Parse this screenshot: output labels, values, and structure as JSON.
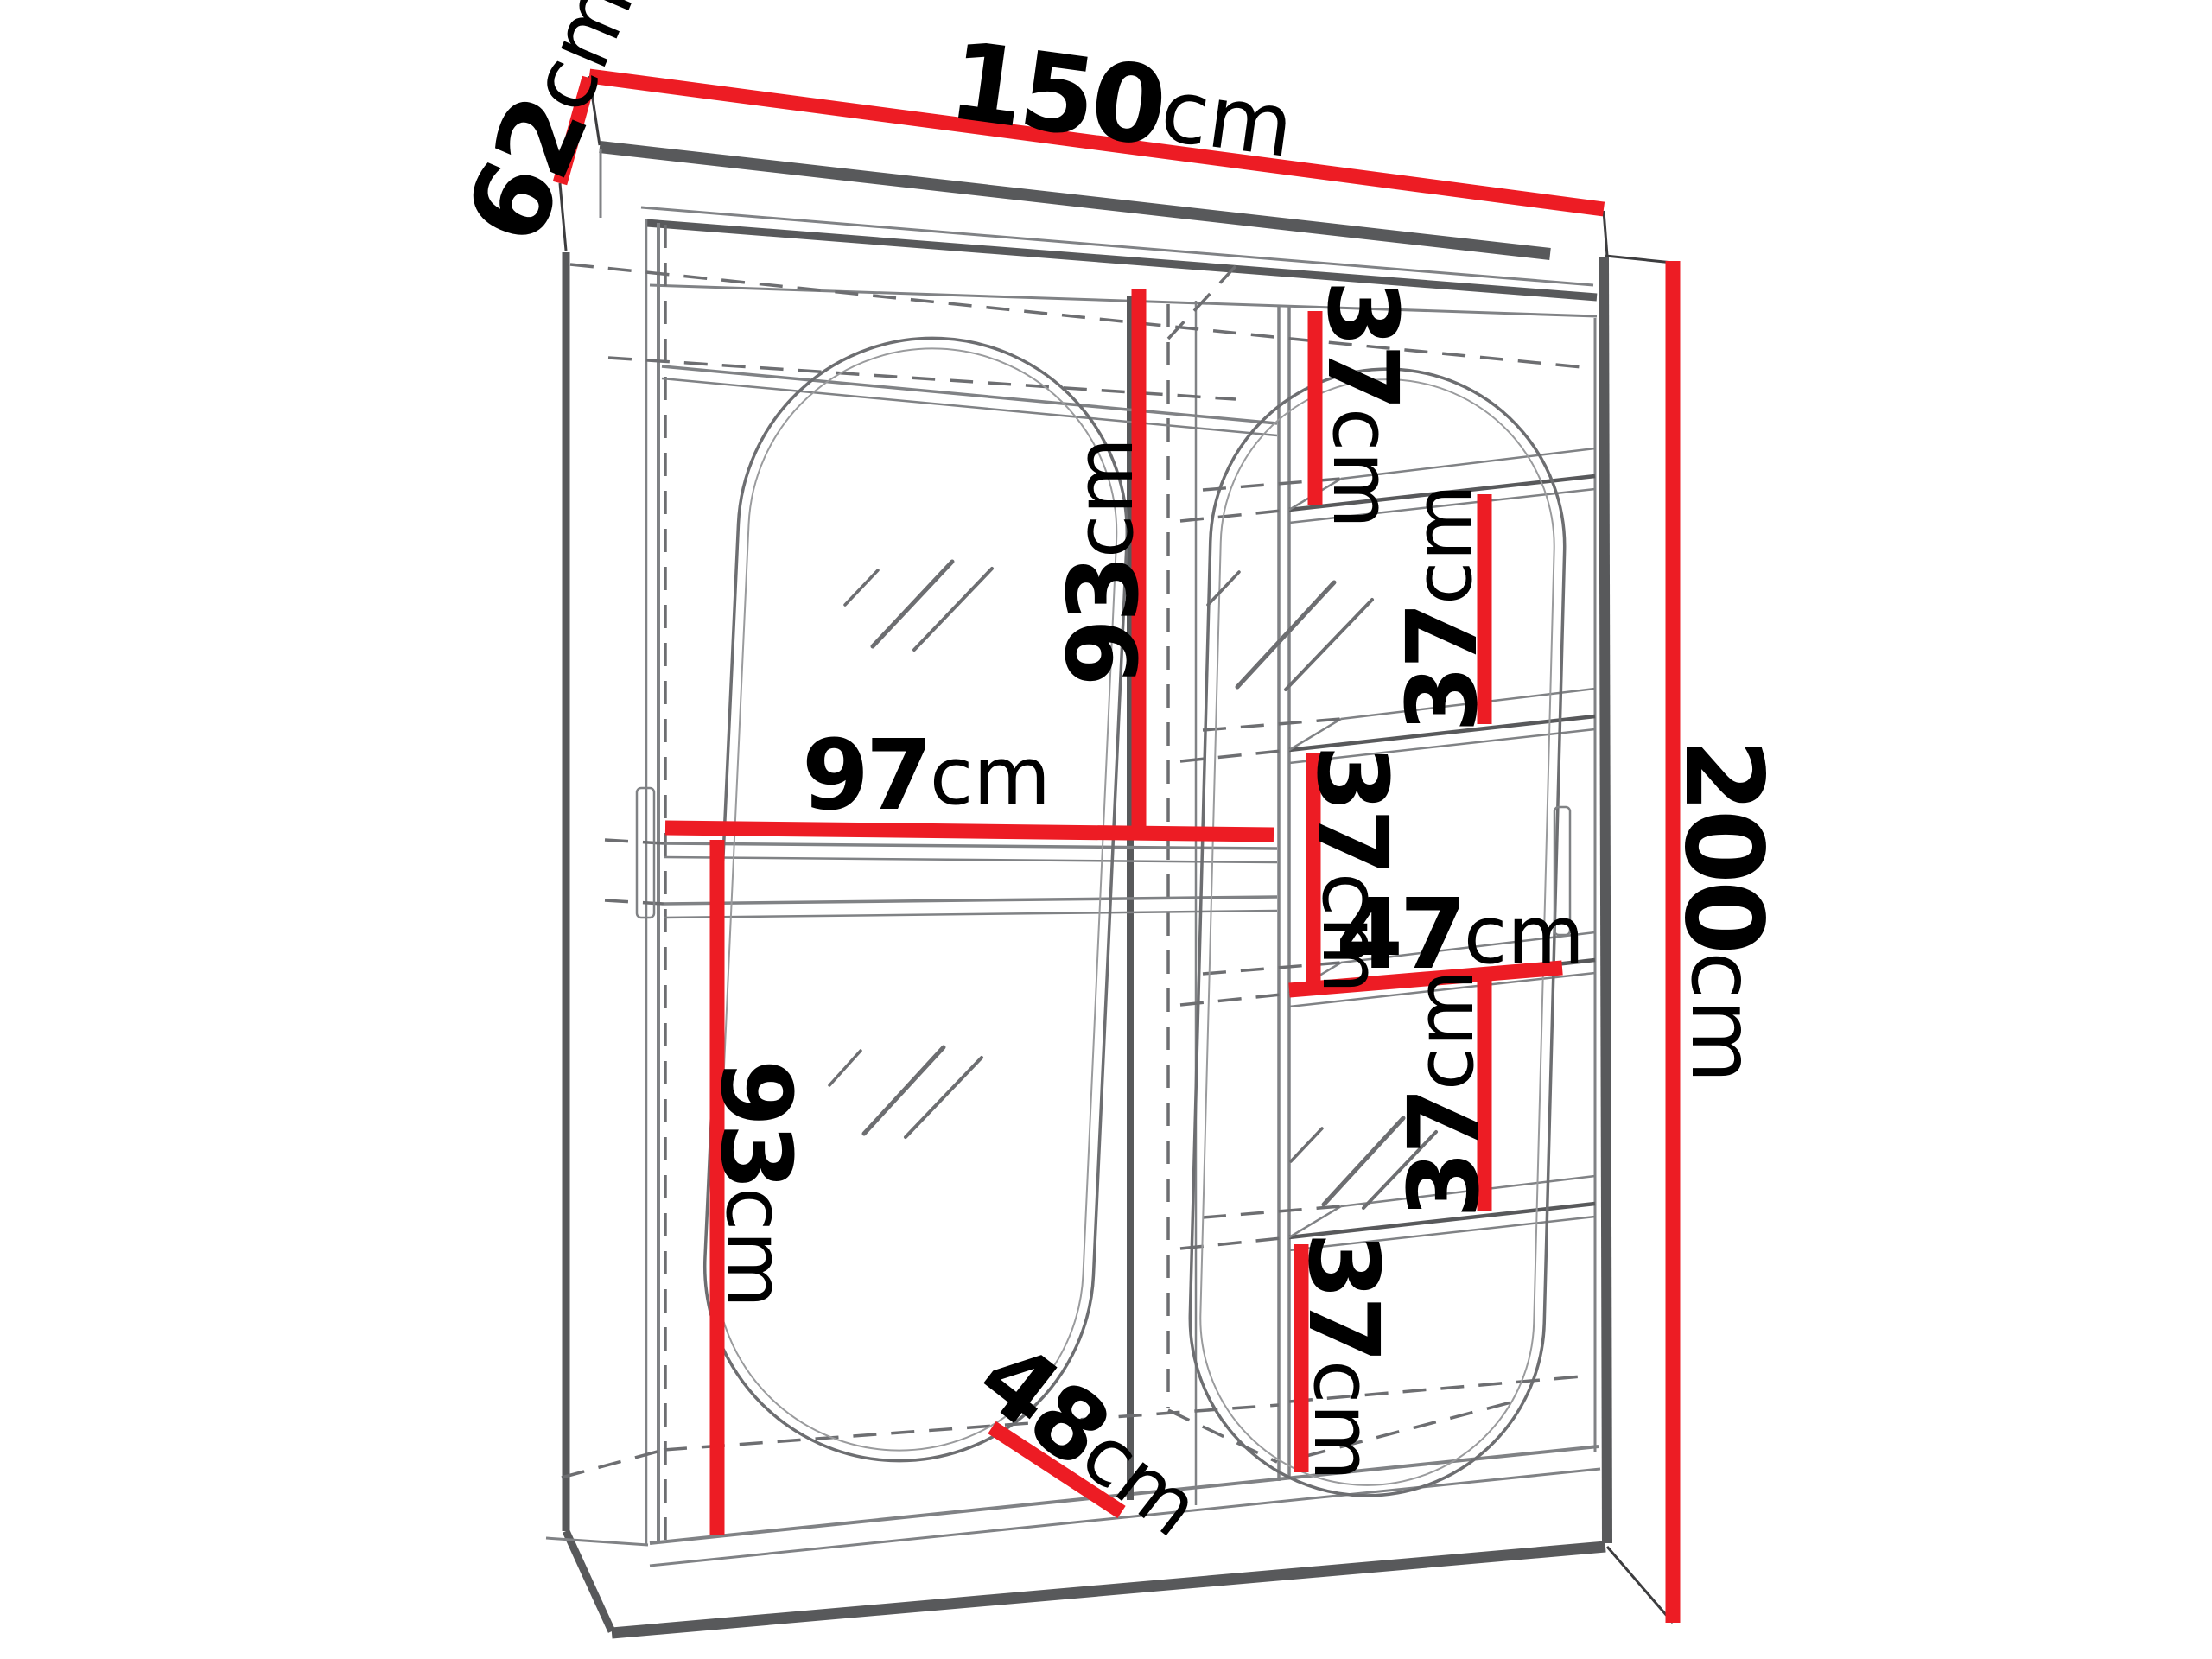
{
  "diagram": {
    "type": "furniture-dimension-diagram",
    "subject": "two-door sliding wardrobe with oval mirrors, hanging sections and shelf column",
    "units": "cm",
    "colors": {
      "dimension_line": "#ED1C24",
      "edge": "#58595B",
      "line": "#808285",
      "hidden_line": "#6D6E71",
      "label_text": "#000000",
      "background": "#FFFFFF"
    },
    "dimensions": {
      "width": {
        "value": "150",
        "unit": "cm"
      },
      "depth": {
        "value": "62",
        "unit": "cm"
      },
      "height": {
        "value": "200",
        "unit": "cm"
      },
      "hanging_section_width": {
        "value": "97",
        "unit": "cm"
      },
      "hanging_top_height": {
        "value": "93",
        "unit": "cm"
      },
      "hanging_bottom_height": {
        "value": "93",
        "unit": "cm"
      },
      "shelf_column_width": {
        "value": "47",
        "unit": "cm"
      },
      "shelf_spacing": {
        "value": "37",
        "unit": "cm"
      },
      "plinth_depth": {
        "value": "48",
        "unit": "cm"
      }
    }
  }
}
